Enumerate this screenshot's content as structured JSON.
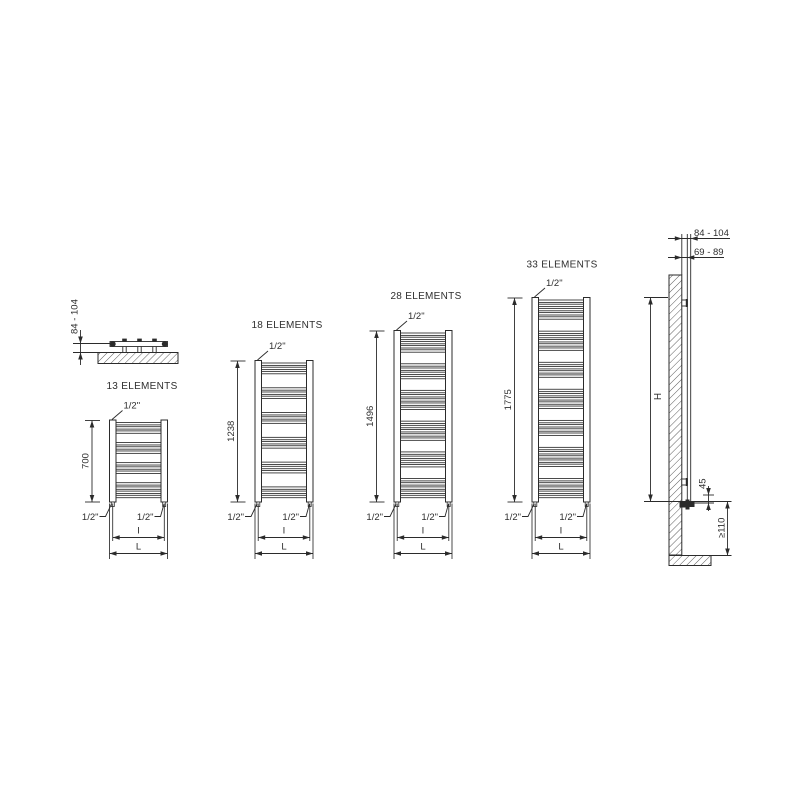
{
  "background": "#ffffff",
  "line_color": "#2b2b2b",
  "text_color": "#2e2e2e",
  "plan_view": {
    "wall_distance_label": "84 - 104"
  },
  "radiators": [
    {
      "name": "13 ELEMENTS",
      "height_mm": "700",
      "top_connection": "1/2\"",
      "bottom_left_connection": "1/2\"",
      "bottom_right_connection": "1/2\"",
      "interaxis_label": "I",
      "width_label": "L",
      "elements": 13,
      "element_groups": [
        3,
        3,
        3,
        4
      ]
    },
    {
      "name": "18 ELEMENTS",
      "height_mm": "1238",
      "top_connection": "1/2\"",
      "bottom_left_connection": "1/2\"",
      "bottom_right_connection": "1/2\"",
      "interaxis_label": "I",
      "width_label": "L",
      "elements": 18,
      "element_groups": [
        3,
        3,
        3,
        3,
        3,
        3
      ]
    },
    {
      "name": "28 ELEMENTS",
      "height_mm": "1496",
      "top_connection": "1/2\"",
      "bottom_left_connection": "1/2\"",
      "bottom_right_connection": "1/2\"",
      "interaxis_label": "I",
      "width_label": "L",
      "elements": 28,
      "element_groups": [
        5,
        4,
        5,
        5,
        4,
        5
      ]
    },
    {
      "name": "33 ELEMENTS",
      "height_mm": "1775",
      "top_connection": "1/2\"",
      "bottom_left_connection": "1/2\"",
      "bottom_right_connection": "1/2\"",
      "interaxis_label": "I",
      "width_label": "L",
      "elements": 33,
      "element_groups": [
        5,
        5,
        4,
        5,
        4,
        5,
        5
      ]
    }
  ],
  "side_view": {
    "center_distance_label": "84 - 104",
    "face_distance_label": "69 - 89",
    "height_label": "H",
    "valve_offset_label": "45",
    "min_floor_clearance_label": "≥110"
  }
}
